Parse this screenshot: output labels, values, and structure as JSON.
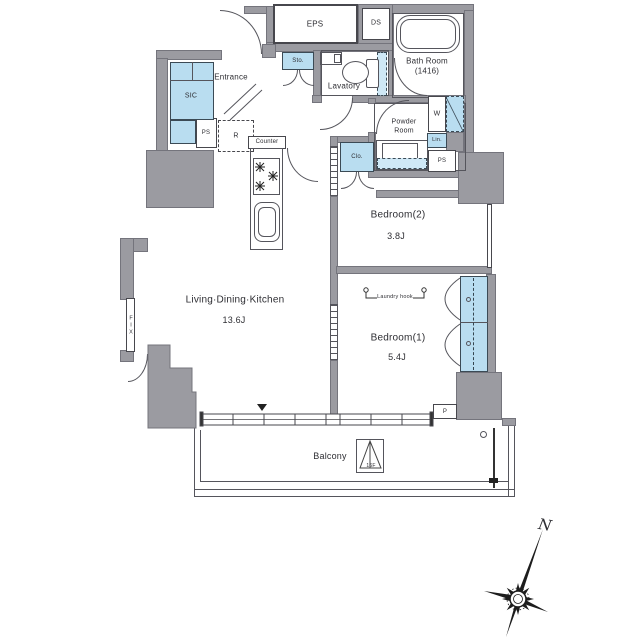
{
  "colors": {
    "wall": "#9b9ba1",
    "fixture": "#b9ddf0",
    "line": "#55555c",
    "text": "#2e2e33"
  },
  "plan": {
    "rooms": {
      "ldk": {
        "name": "Living·Dining·Kitchen",
        "size": "13.6J"
      },
      "bedroom1": {
        "name": "Bedroom(1)",
        "size": "5.4J"
      },
      "bedroom2": {
        "name": "Bedroom(2)",
        "size": "3.8J"
      },
      "bath": {
        "name": "Bath Room",
        "size": "(1416)"
      },
      "lavatory": {
        "name": "Lavatory"
      },
      "powder_room": {
        "line1": "Powder",
        "line2": "Room"
      },
      "entrance": {
        "name": "Entrance"
      },
      "balcony": {
        "name": "Balcony"
      }
    },
    "labels": {
      "eps": "EPS",
      "ds": "DS",
      "sic": "SIC",
      "storage": "Sto.",
      "counter": "Counter",
      "refrigerator": "R",
      "pipe_space": "PS",
      "washer": "W",
      "linen": "Lin.",
      "closet": "Clo.",
      "pipe": "P",
      "fix_window": "FIX",
      "laundry_hook": "Laundry hook",
      "evac_hatch": "16F"
    },
    "compass": {
      "north": "N"
    }
  }
}
